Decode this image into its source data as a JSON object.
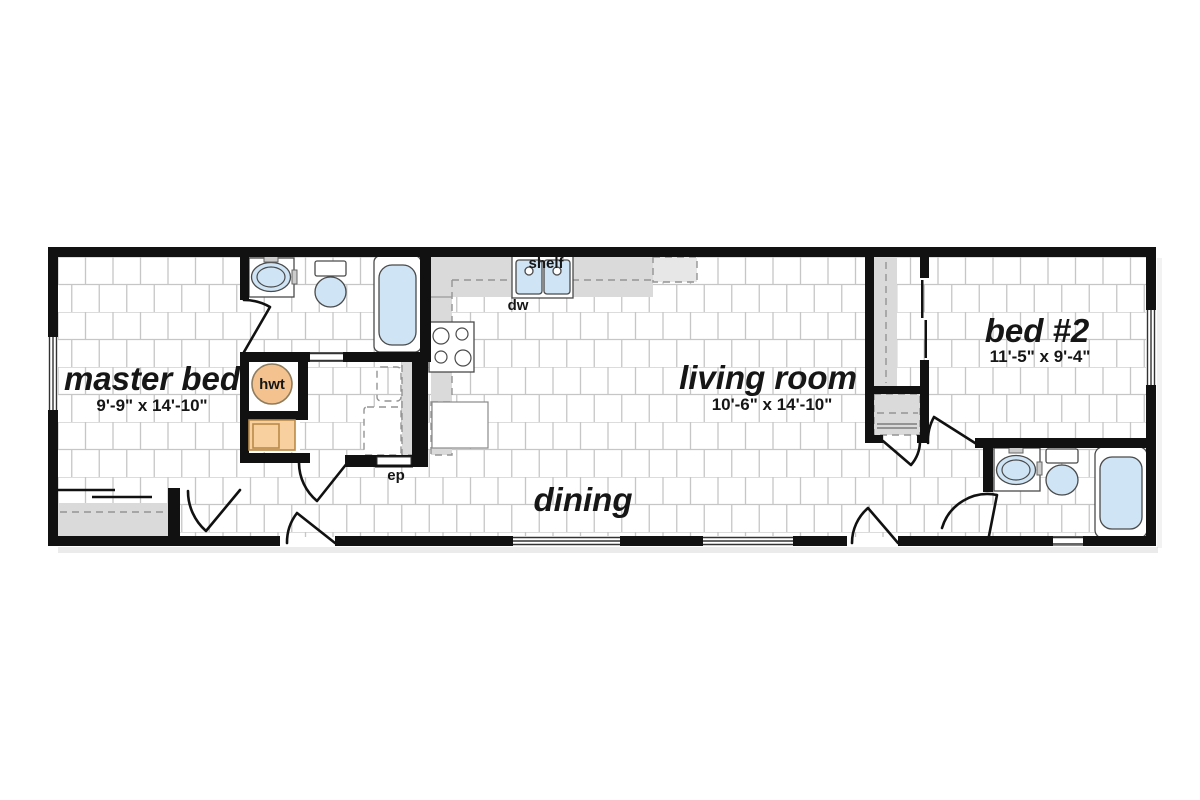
{
  "rooms": {
    "master": {
      "name": "master bed",
      "dims": "9'-9\" x 14'-10\""
    },
    "living": {
      "name": "living room",
      "dims": "10'-6\" x 14'-10\""
    },
    "bed2": {
      "name": "bed #2",
      "dims": "11'-5\" x 9'-4\""
    },
    "dining": {
      "name": "dining"
    }
  },
  "labels": {
    "shelf": "shelf",
    "dishwasher": "dw",
    "electrical_panel": "ep",
    "water_heater": "hwt"
  },
  "colors": {
    "wall": "#111111",
    "fixture_blue": "#cfe4f4",
    "counter_gray": "#dadada",
    "closet_gray": "#d8d8d8",
    "appliance_orange": "#f8cf9e",
    "water_heater_fill": "#f4c28e",
    "tile_line": "#c6c6c6"
  }
}
